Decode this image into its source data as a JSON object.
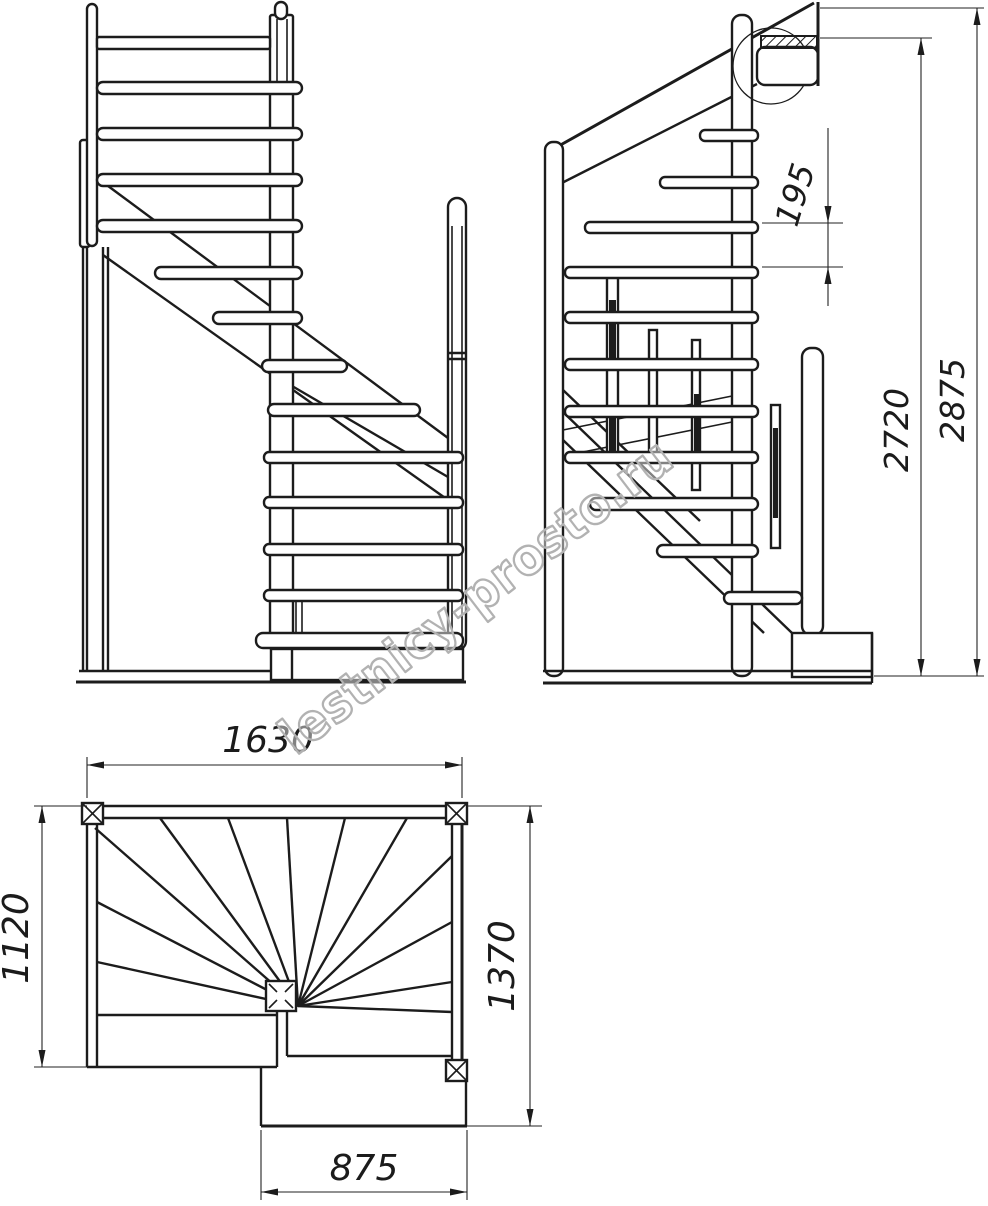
{
  "drawing": {
    "kind": "staircase technical drawing",
    "views": {
      "front": "front elevation",
      "side": "side elevation",
      "plan": "plan view"
    }
  },
  "dimensions": {
    "rail_spacing": "195",
    "floor_height": "2720",
    "overall_height": "2875",
    "plan_width": "1630",
    "plan_depth_left": "1120",
    "plan_depth_right": "1370",
    "lower_step_width": "875"
  },
  "watermark": {
    "text": "lestnicy-prosto.ru",
    "color": "#b2b2b2"
  },
  "colors": {
    "line": "#1c1c1c",
    "background": "#ffffff"
  }
}
